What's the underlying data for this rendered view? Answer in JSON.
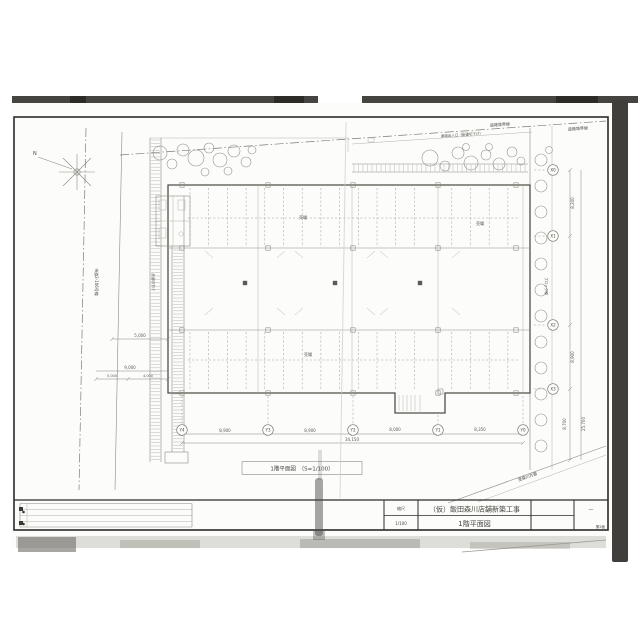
{
  "title_block": {
    "scale_label": "縮尺",
    "scale_value": "1/100",
    "project_name": "（仮）飯田森川店舗新築工事",
    "drawing_name": "1階平面図",
    "dash": "—",
    "sheet_no": "第2面"
  },
  "plan": {
    "caption": "1階平面図　（S=1/100）",
    "north": "N",
    "labels": {
      "road_boundary_top": "道路境界線",
      "road_boundary_top2": "道路境界線",
      "vehicle_entrance": "車両出入口（歩道切下げ）",
      "left_road": "市道2-106号線",
      "left_sidewalk": "歩道切下げ",
      "block_wall": "ブロック塀",
      "to_direction": "至森川方面"
    },
    "room_labels": [
      "売場",
      "売場",
      "売場"
    ],
    "grid": {
      "y": [
        "Y4",
        "Y3",
        "Y2",
        "Y1",
        "Y0"
      ],
      "x": [
        "X0",
        "X1",
        "X2",
        "X3"
      ]
    },
    "dims": {
      "bottom": [
        "8,900",
        "8,900",
        "8,000",
        "8,350"
      ],
      "bottom_total": "34,150",
      "right": [
        "8,200",
        "8,900",
        "8,700"
      ],
      "right_total": "25,700",
      "left": [
        "5,000",
        "9,000",
        "5,000",
        "4,000"
      ]
    }
  }
}
